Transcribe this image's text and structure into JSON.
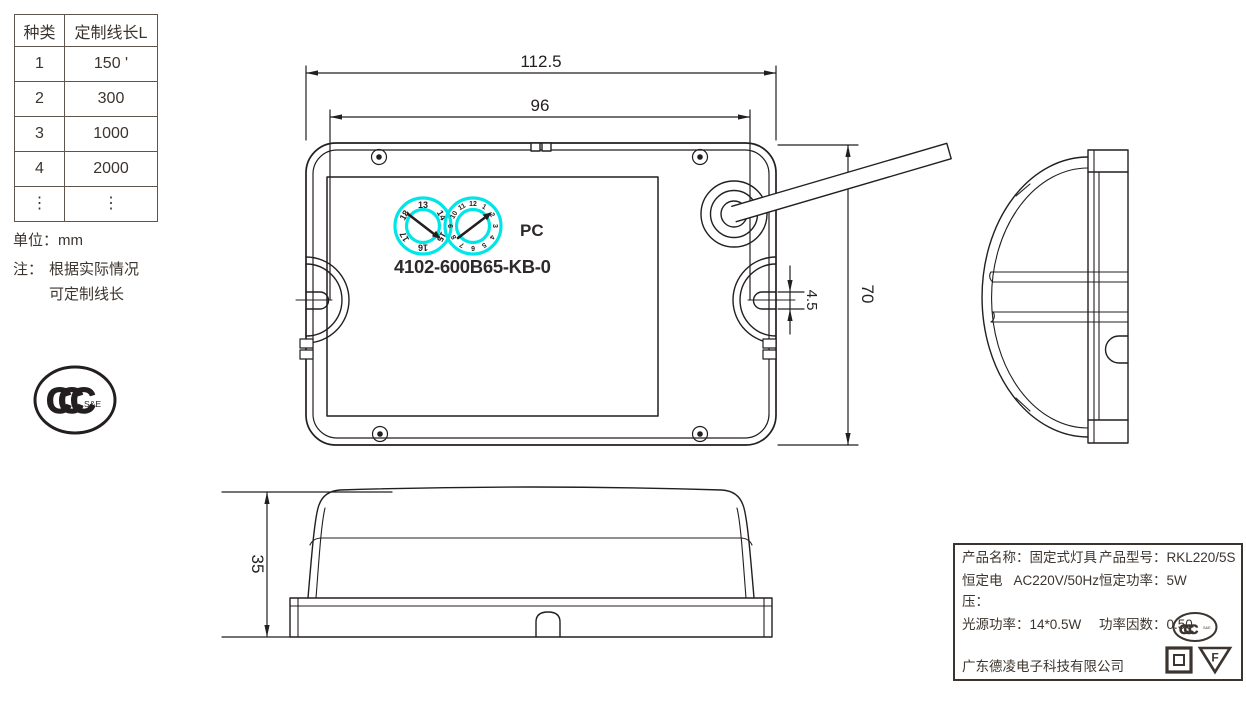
{
  "colors": {
    "line": "#231f20",
    "accent_cyan": "#00e6e6",
    "background": "#ffffff"
  },
  "spec_table": {
    "headers": [
      "种类",
      "定制线长L"
    ],
    "rows": [
      [
        "1",
        "150 '"
      ],
      [
        "2",
        "300"
      ],
      [
        "3",
        "1000"
      ],
      [
        "4",
        "2000"
      ],
      [
        "⋮",
        "⋮"
      ]
    ]
  },
  "notes": {
    "unit": "单位：mm",
    "note_prefix": "注：",
    "note_line1": "根据实际情况",
    "note_line2": "可定制线长"
  },
  "ccc_logo": {
    "letters": "CCC",
    "suffix": "S&E"
  },
  "top_view": {
    "dim_outer_width": "112.5",
    "dim_inner_width": "96",
    "dim_height": "70",
    "dim_slot": "4.5",
    "material": "PC",
    "model": "4102-600B65-KB-0",
    "dial1": [
      "13",
      "14",
      "15",
      "16",
      "17",
      "18"
    ],
    "dial2": [
      "1",
      "2",
      "3",
      "4",
      "5",
      "6",
      "7",
      "8",
      "9",
      "10",
      "11",
      "12"
    ]
  },
  "front_view": {
    "dim_height": "35"
  },
  "label": {
    "rows": [
      {
        "k1": "产品名称：",
        "v1": "固定式灯具",
        "k2": "产品型号：",
        "v2": "RKL220/5S"
      },
      {
        "k1": "恒定电压：",
        "v1": "AC220V/50Hz",
        "k2": "恒定功率：",
        "v2": "5W"
      },
      {
        "k1": "光源功率：",
        "v1": "14*0.5W",
        "k2": "功率因数：",
        "v2": "0.50"
      }
    ],
    "company": "广东德凌电子科技有限公司",
    "ccc_letters": "CCC",
    "ccc_suffix": "S&E",
    "f_mark": "F"
  }
}
